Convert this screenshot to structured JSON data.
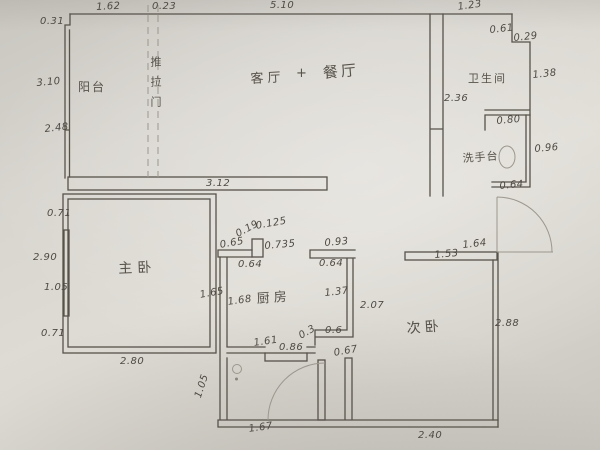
{
  "palette": {
    "paper": "#d6d3cc",
    "pencil_line": "#57534b",
    "faint_line": "#9b978e",
    "ink": "#4e4a43"
  },
  "rooms": [
    {
      "name": "balcony-label",
      "text": "阳台",
      "x": 78,
      "y": 78,
      "size": 12,
      "ls": 2
    },
    {
      "name": "living-room-label",
      "text": "客厅",
      "x": 250,
      "y": 68,
      "size": 13,
      "ls": 4,
      "rot": -3
    },
    {
      "name": "plus-sign",
      "text": "+",
      "x": 296,
      "y": 66,
      "size": 13
    },
    {
      "name": "dining-room-label",
      "text": "餐厅",
      "x": 322,
      "y": 62,
      "size": 15,
      "ls": 3,
      "rot": -5
    },
    {
      "name": "sliding-door-label",
      "text": "推拉门",
      "x": 147,
      "y": 56,
      "size": 11,
      "ls": 9,
      "vertical": true
    },
    {
      "name": "bathroom-label",
      "text": "卫生间",
      "x": 468,
      "y": 70,
      "size": 11,
      "ls": 2
    },
    {
      "name": "washstand-label",
      "text": "洗手台",
      "x": 462,
      "y": 150,
      "size": 11,
      "ls": 1,
      "rot": -4
    },
    {
      "name": "master-bedroom-label",
      "text": "主卧",
      "x": 118,
      "y": 258,
      "size": 14,
      "ls": 5,
      "rot": -2
    },
    {
      "name": "kitchen-label",
      "text": "厨房",
      "x": 256,
      "y": 288,
      "size": 13,
      "ls": 4,
      "rot": -4
    },
    {
      "name": "second-bedroom-label",
      "text": "次卧",
      "x": 406,
      "y": 318,
      "size": 14,
      "ls": 4,
      "rot": -4
    }
  ],
  "dimensions": [
    {
      "text": "1.62",
      "x": 96,
      "y": 2,
      "rot": -3
    },
    {
      "text": "0.23",
      "x": 152,
      "y": 1
    },
    {
      "text": "5.10",
      "x": 270,
      "y": 0
    },
    {
      "text": "1.23",
      "x": 457,
      "y": 2,
      "rot": -8
    },
    {
      "text": "0.31",
      "x": 40,
      "y": 16
    },
    {
      "text": "3.10",
      "x": 36,
      "y": 78,
      "rot": -5
    },
    {
      "text": "2.48",
      "x": 44,
      "y": 124,
      "rot": -6
    },
    {
      "text": "0.61",
      "x": 489,
      "y": 25,
      "rot": -6
    },
    {
      "text": "0.29",
      "x": 513,
      "y": 33,
      "rot": -6
    },
    {
      "text": "1.38",
      "x": 532,
      "y": 70,
      "rot": -6
    },
    {
      "text": "2.36",
      "x": 444,
      "y": 93
    },
    {
      "text": "0.80",
      "x": 496,
      "y": 116,
      "rot": -5
    },
    {
      "text": "0.96",
      "x": 534,
      "y": 144,
      "rot": -5
    },
    {
      "text": "0.64",
      "x": 499,
      "y": 181,
      "rot": -5
    },
    {
      "text": "3.12",
      "x": 206,
      "y": 178
    },
    {
      "text": "1.64",
      "x": 462,
      "y": 240,
      "rot": -6
    },
    {
      "text": "1.53",
      "x": 434,
      "y": 250,
      "rot": -5
    },
    {
      "text": "2.88",
      "x": 495,
      "y": 318
    },
    {
      "text": "2.40",
      "x": 418,
      "y": 430
    },
    {
      "text": "0.71",
      "x": 47,
      "y": 208
    },
    {
      "text": "2.90",
      "x": 33,
      "y": 252
    },
    {
      "text": "1.05",
      "x": 44,
      "y": 282
    },
    {
      "text": "0.71",
      "x": 41,
      "y": 328
    },
    {
      "text": "2.80",
      "x": 120,
      "y": 356
    },
    {
      "text": "1.65",
      "x": 199,
      "y": 290,
      "rot": -10
    },
    {
      "text": "1.05",
      "x": 193,
      "y": 396,
      "rot": -72
    },
    {
      "text": "1.67",
      "x": 248,
      "y": 424,
      "rot": -8
    },
    {
      "text": "0.65",
      "x": 219,
      "y": 240,
      "rot": -10
    },
    {
      "text": "0.19",
      "x": 234,
      "y": 230,
      "rot": -28
    },
    {
      "text": "0.125",
      "x": 255,
      "y": 221,
      "rot": -10
    },
    {
      "text": "0.735",
      "x": 264,
      "y": 241,
      "rot": -5
    },
    {
      "text": "0.64",
      "x": 238,
      "y": 259
    },
    {
      "text": "0.93",
      "x": 324,
      "y": 238,
      "rot": -5
    },
    {
      "text": "0.64",
      "x": 319,
      "y": 258
    },
    {
      "text": "1.68",
      "x": 227,
      "y": 297,
      "rot": -8
    },
    {
      "text": "1.37",
      "x": 324,
      "y": 288,
      "rot": -6
    },
    {
      "text": "2.07",
      "x": 360,
      "y": 300
    },
    {
      "text": "0.6",
      "x": 325,
      "y": 325
    },
    {
      "text": "0.3",
      "x": 297,
      "y": 332,
      "rot": -30
    },
    {
      "text": "1.61",
      "x": 253,
      "y": 338,
      "rot": -8
    },
    {
      "text": "0.86",
      "x": 279,
      "y": 342
    },
    {
      "text": "0.67",
      "x": 333,
      "y": 348,
      "rot": -10
    }
  ]
}
